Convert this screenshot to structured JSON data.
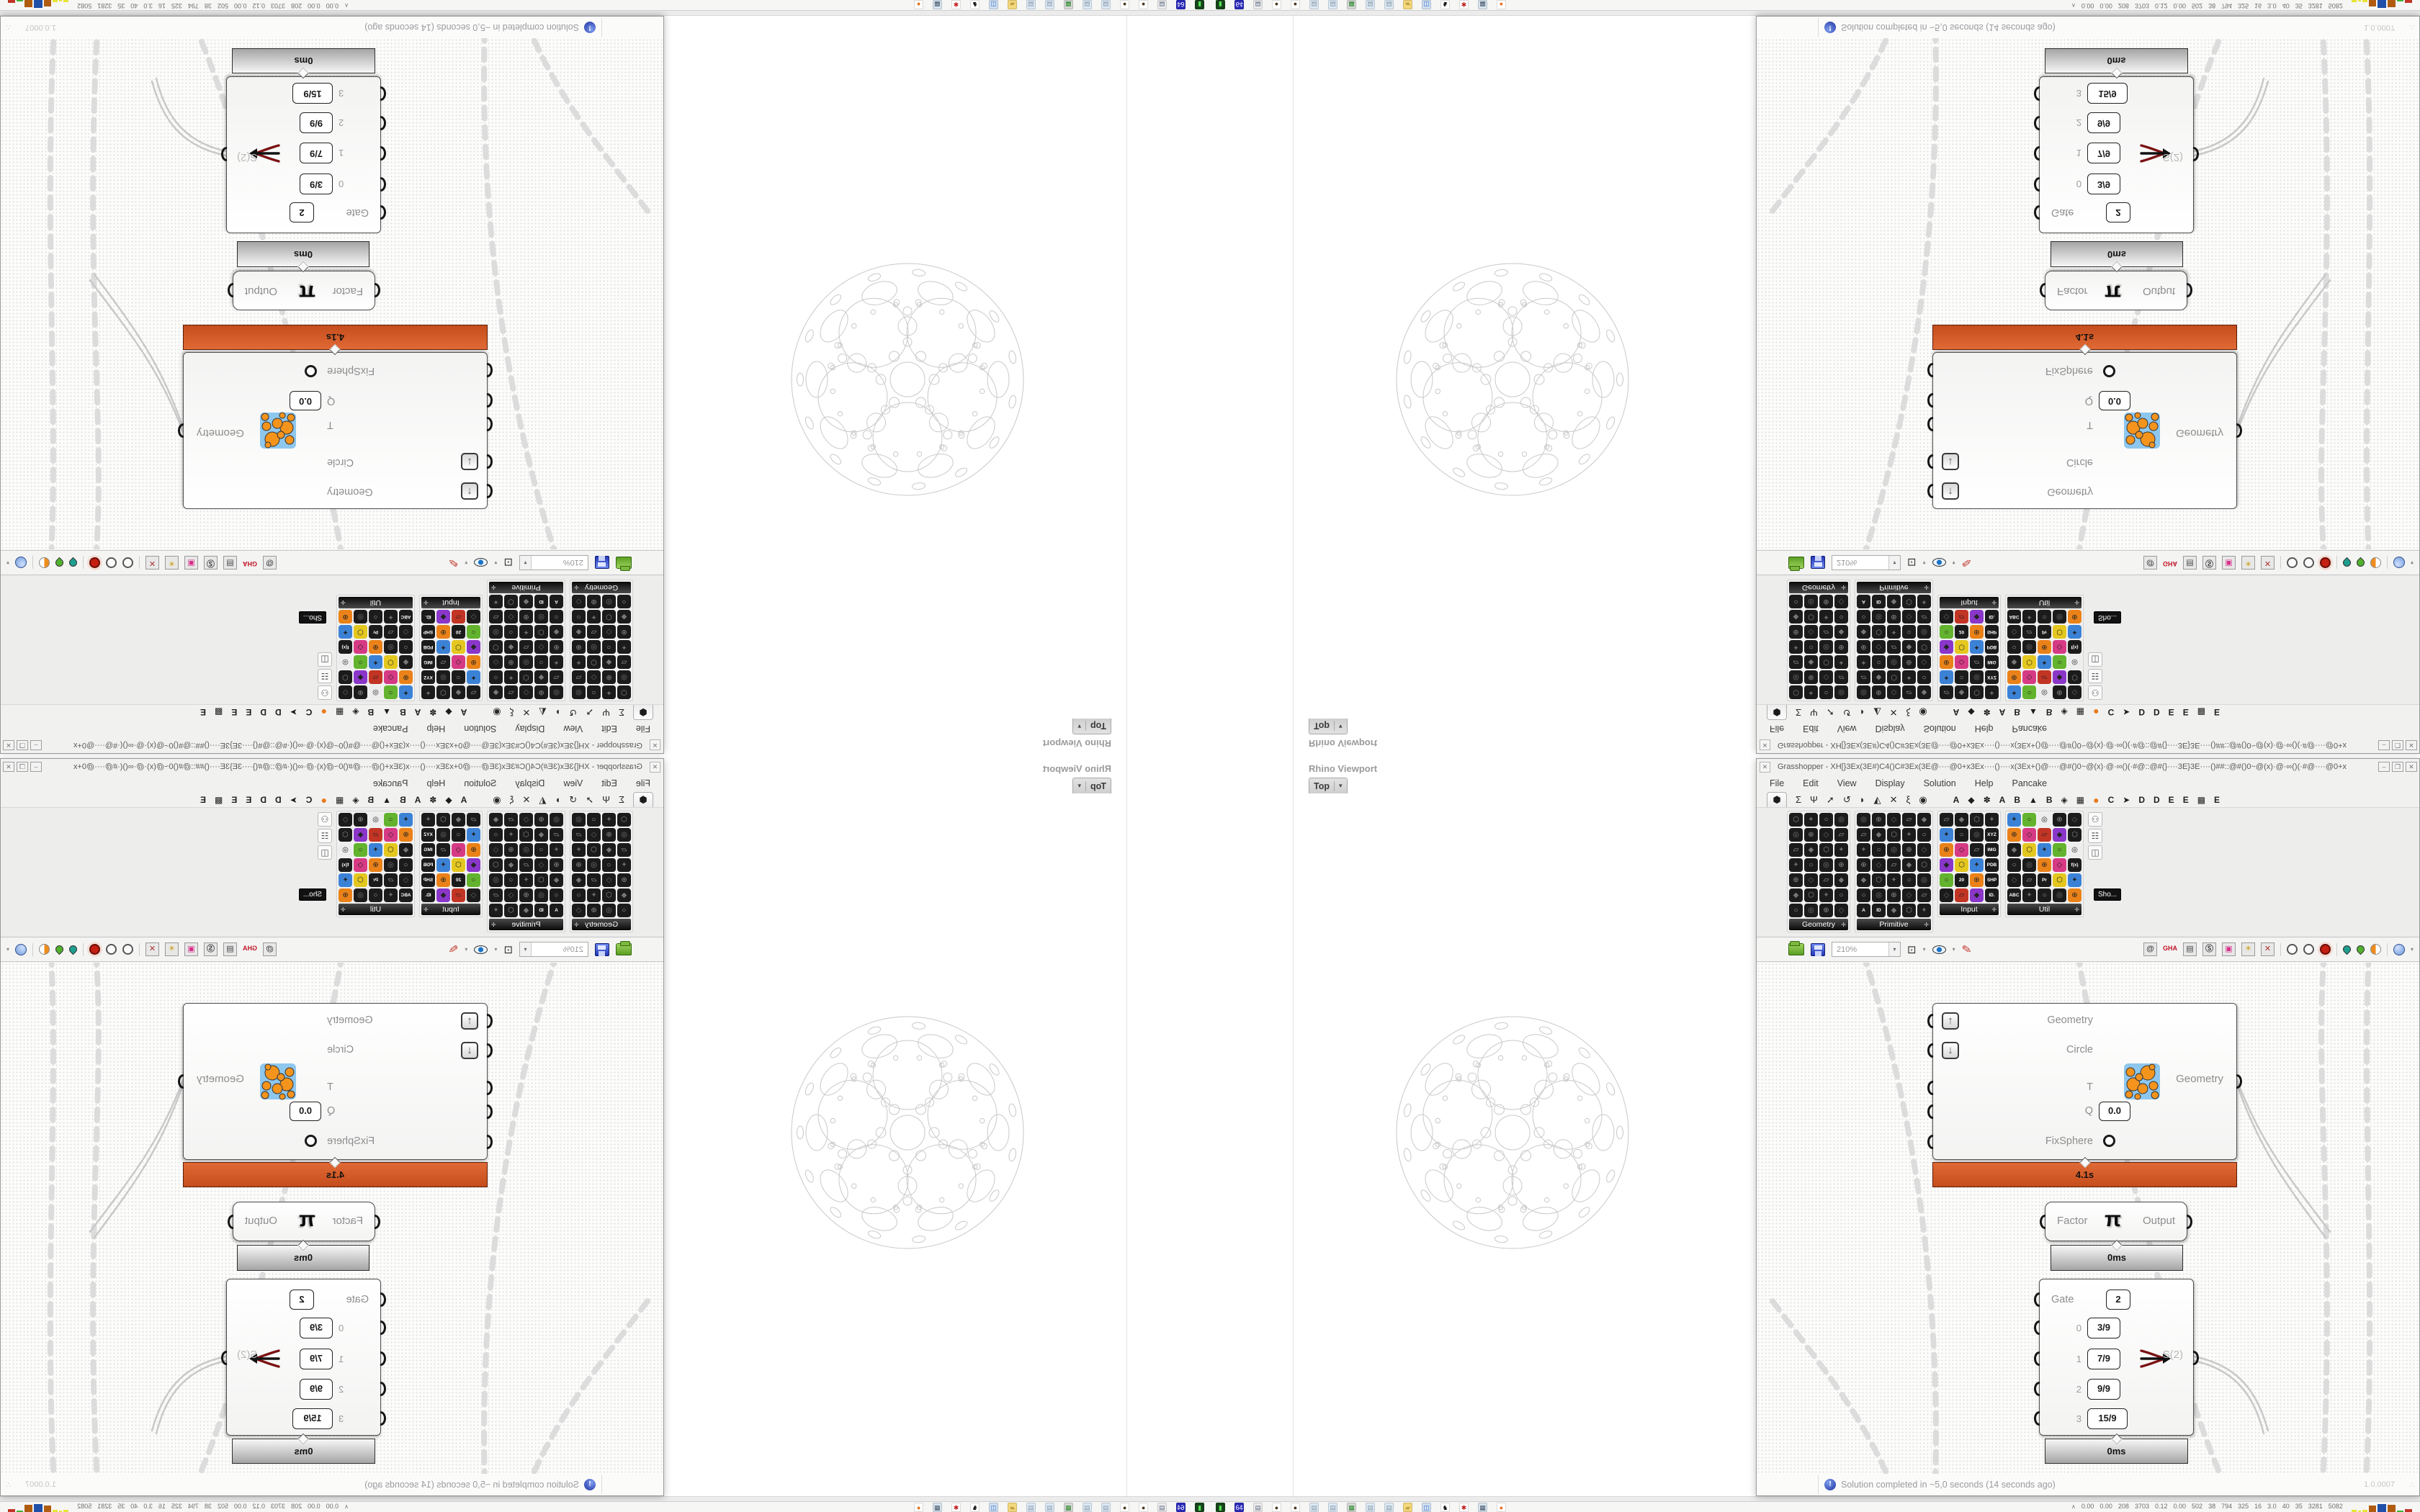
{
  "rhino": {
    "panel_title": "Rhino Viewport",
    "viewport_tab": "Top",
    "viewport_caret": "▾"
  },
  "grasshopper": {
    "window_title": "Grasshopper - XH[}3Ex(3E#)C4()C#3Ex(3E@····@0+x3Ex····()····x(3Ex+()@····@#()0~@(x)·@·∞()(·#@::@#(}····3E}3E····()##::@#()0~@(x)·@·∞()(·#@····@0+x3Ex····()····()····...",
    "panel_close_glyph": "✕",
    "window_buttons": {
      "minimize": "–",
      "maximize": "❒",
      "close": "✕"
    },
    "menus": [
      "File",
      "Edit",
      "View",
      "Display",
      "Solution",
      "Help",
      "Pancake"
    ],
    "category_tabs": {
      "active_glyph": "⬢",
      "core_glyphs": [
        "Σ",
        "Ψ",
        "➚",
        "↺",
        "◗",
        "◭",
        "✕",
        "ξ",
        "◉"
      ],
      "plugin_tabs": [
        "A",
        "◆",
        "✽",
        "A",
        "B",
        "▲",
        "B",
        "◈",
        "▦",
        "●",
        "C",
        "➤",
        "D",
        "D",
        "E",
        "E",
        "▩",
        "E"
      ],
      "orange_tab_color": "#e87c1e"
    },
    "palettes": {
      "panels": [
        {
          "label": "Geometry",
          "cols": 4,
          "rows": 7,
          "colorful": false,
          "labeled_cells": []
        },
        {
          "label": "Primitive",
          "cols": 5,
          "rows": 7,
          "colorful": false,
          "labeled_cells": [
            [
              6,
              0,
              "A"
            ],
            [
              6,
              1,
              "ID"
            ]
          ]
        },
        {
          "label": "Input",
          "cols": 4,
          "rows": 6,
          "colorful": true,
          "labeled_cells": [
            [
              1,
              3,
              "XYZ"
            ],
            [
              2,
              3,
              "IMG"
            ],
            [
              3,
              3,
              "PDB"
            ],
            [
              4,
              3,
              "SHP"
            ],
            [
              4,
              1,
              "20"
            ],
            [
              5,
              3,
              "ID."
            ]
          ]
        },
        {
          "label": "Util",
          "cols": 5,
          "rows": 6,
          "colorful": true,
          "labeled_cells": [
            [
              4,
              2,
              "Pr"
            ],
            [
              3,
              4,
              "f(x)"
            ],
            [
              5,
              0,
              "ABC"
            ]
          ]
        }
      ],
      "overflow_icons": [
        "⚇",
        "☷",
        "◫"
      ],
      "overflow_tooltip": "Sho...",
      "accent_colors": [
        "#e4c71f",
        "#d63a84",
        "#63b32e",
        "#8a36c9",
        "#ea8219",
        "#3b82d6",
        "#c23424",
        "#ededed"
      ],
      "icon_glyphs": [
        "⬡",
        "◇",
        "○",
        "◆",
        "⊕",
        "✦",
        "▱",
        "◎"
      ]
    },
    "canvas_toolbar": {
      "zoom_value": "210%",
      "left_icons": [
        "open-file-icon",
        "save-file-icon",
        "zoom-select",
        "zoom-extents-icon",
        "preview-eye-icon",
        "wire-brush-icon"
      ],
      "zoom_extents_glyph": "⊡",
      "caret_glyph": "▾",
      "right_icons": [
        {
          "name": "remote-panel-icon",
          "glyph": "@"
        },
        {
          "name": "gha-assembly-icon",
          "glyph": "GHA"
        },
        {
          "name": "notes-window-icon",
          "glyph": "▤"
        },
        {
          "name": "search-icon",
          "glyph": "Ⓢ"
        },
        {
          "name": "package-help-icon",
          "glyph": "▣"
        },
        {
          "name": "idea-lamp-icon",
          "glyph": "☀"
        },
        {
          "name": "wires-cross-icon",
          "glyph": "✕"
        }
      ],
      "collapse_glyph": "≡"
    },
    "components": {
      "fixsphere": {
        "inputs": [
          {
            "label": "Geometry",
            "button": "↑"
          },
          {
            "label": "Circle",
            "button": "↓"
          },
          {
            "label": "T"
          },
          {
            "label": "Q",
            "value": "0.0"
          },
          {
            "label": "FixSphere",
            "toggle": true
          }
        ],
        "output_label": "Geometry",
        "runtime": "4.1s"
      },
      "pi": {
        "input_label": "Factor",
        "symbol": "π",
        "output_label": "Output",
        "runtime": "0ms"
      },
      "stream_filter": {
        "gate_label": "Gate",
        "gate_value": "2",
        "rows": [
          {
            "index": "0",
            "value": "3/9"
          },
          {
            "index": "1",
            "value": "7/9"
          },
          {
            "index": "2",
            "value": "9/9"
          },
          {
            "index": "3",
            "value": "15/9"
          }
        ],
        "output_label": "S(2)",
        "runtime": "0ms"
      }
    },
    "status_bar": {
      "info_glyph": "!",
      "message": "Solution completed in ~5,0 seconds (14 seconds ago)",
      "version": "1.0.0007",
      "grip": "∴"
    }
  },
  "taskbar": {
    "icons": [
      {
        "name": "terminal-icon",
        "glyph": "▮",
        "bg": "#16441a",
        "fg": "#55e055"
      },
      {
        "name": "save-64-icon",
        "glyph": "64",
        "bg": "#2a2ab8",
        "fg": "#ffffff"
      },
      {
        "name": "print-notes-icon",
        "glyph": "▤",
        "bg": "#ececec",
        "fg": "#667088"
      },
      {
        "name": "walnut-icon",
        "glyph": "●",
        "bg": "#ffffff",
        "fg": "#4a3b1e"
      },
      {
        "name": "walnut-icon",
        "glyph": "●",
        "bg": "#ffffff",
        "fg": "#4a3b1e"
      },
      {
        "name": "notepad-icon",
        "glyph": "▤",
        "bg": "#dce9f5",
        "fg": "#8899aa"
      },
      {
        "name": "notepad-icon",
        "glyph": "▤",
        "bg": "#dce9f5",
        "fg": "#8899aa"
      },
      {
        "name": "monitor-icon",
        "glyph": "▦",
        "bg": "#d8d8d8",
        "fg": "#2a8a2a"
      },
      {
        "name": "notepad-icon",
        "glyph": "▤",
        "bg": "#dce9f5",
        "fg": "#8899aa"
      },
      {
        "name": "notepad-icon",
        "glyph": "▤",
        "bg": "#dce9f5",
        "fg": "#8899aa"
      },
      {
        "name": "folder-icon",
        "glyph": "▰",
        "bg": "#f3d87c",
        "fg": "#c3a043"
      },
      {
        "name": "computer-icon",
        "glyph": "◫",
        "bg": "#cfe0f2",
        "fg": "#3b6fc4"
      },
      {
        "name": "cat-icon",
        "glyph": "♞",
        "bg": "#ffffff",
        "fg": "#111111"
      },
      {
        "name": "gear-icon",
        "glyph": "✱",
        "bg": "#ffffff",
        "fg": "#c02222"
      },
      {
        "name": "calculator-icon",
        "glyph": "▦",
        "bg": "#d8e4f0",
        "fg": "#445566"
      },
      {
        "name": "firefox-icon",
        "glyph": "●",
        "bg": "#ffffff",
        "fg": "#e8701a"
      }
    ],
    "monitor_caret": "∧",
    "monitor_stats": [
      "0.00",
      "0.00",
      "208",
      "3703",
      "0.12",
      "0.00",
      "502",
      "38",
      "794",
      "325",
      "16",
      "3.0",
      "40",
      "35",
      "3281",
      "5082"
    ],
    "chart_segments": [
      [
        "#e8e436",
        18,
        3
      ],
      [
        "#e8e436",
        10,
        2
      ],
      [
        "#e8e436",
        16,
        3
      ],
      [
        "#b05c10",
        26,
        9
      ],
      [
        "#1f4fa8",
        30,
        11
      ],
      [
        "#b05c10",
        28,
        10
      ],
      [
        "#43b33c",
        24,
        2
      ],
      [
        "#c23428",
        24,
        4
      ]
    ]
  }
}
